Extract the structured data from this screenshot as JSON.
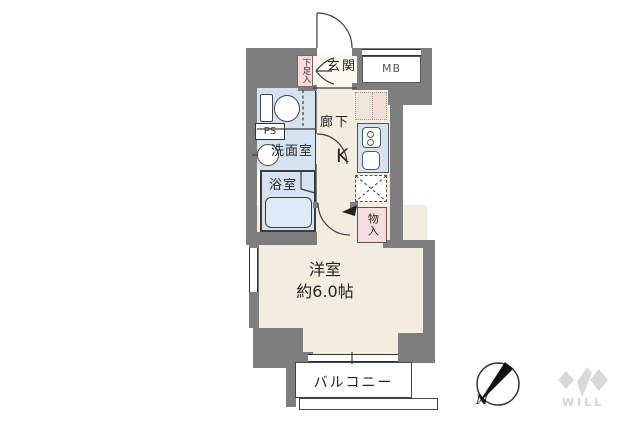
{
  "floorplan": {
    "labels": {
      "genkan": "玄関",
      "shoe_storage": "下足入",
      "meter_box": "MB",
      "pipe_space": "PS",
      "washroom": "洗面室",
      "bathroom": "浴室",
      "corridor": "廊下",
      "kitchen": "K",
      "storage": "物入",
      "main_room_name": "洋室",
      "main_room_size": "約6.0帖",
      "balcony": "バルコニー"
    },
    "compass": {
      "north": "N"
    },
    "brand": {
      "logo_text": "WILL"
    },
    "colors": {
      "wall_gray": "#7e7e7e",
      "floor_cream": "#f3ede0",
      "wet_area_blue": "#d5e3f1",
      "closet_pink": "#f6dcdc",
      "entrance_white": "#fbf8f3",
      "logo_gray": "#d9d9d9",
      "line_dark": "#3c3c3c"
    }
  }
}
